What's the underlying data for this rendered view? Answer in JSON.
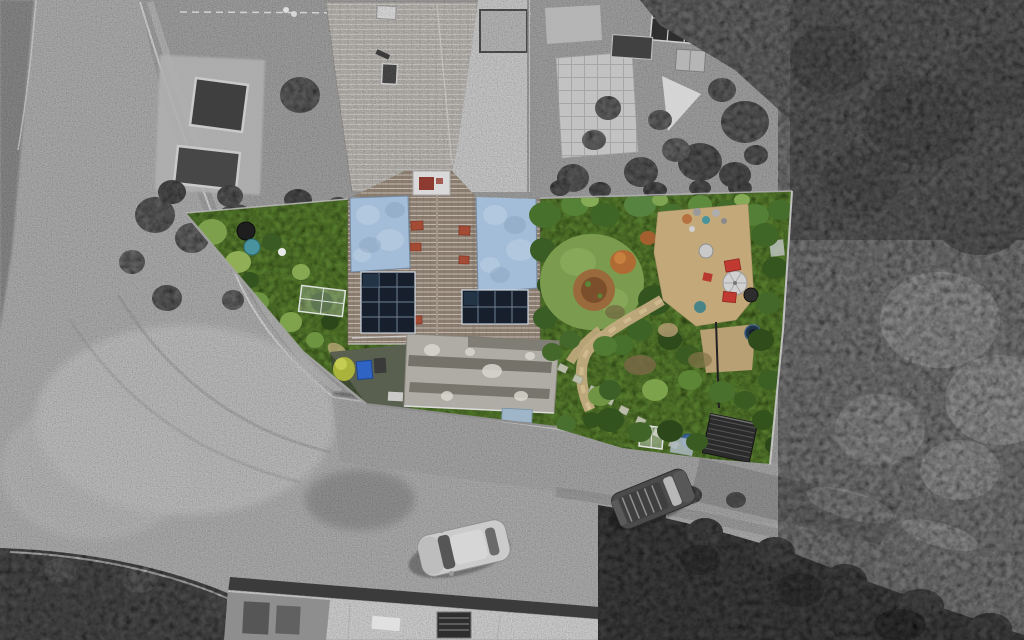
{
  "scene": {
    "type": "aerial-drone-photograph",
    "subject": "Top-down property photograph with the plot shown in colour and the surroundings desaturated to grayscale",
    "style": "estate-agent property highlight"
  },
  "property": {
    "house": {
      "tiled_roof": true,
      "chimney": true,
      "flat_roof_sections": 2,
      "solar_arrays": [
        {
          "position": "left",
          "columns": 3,
          "rows": 4
        },
        {
          "position": "right",
          "columns": 4,
          "rows": 2
        }
      ],
      "rear_extension_flat_roof": true,
      "skylight": true
    },
    "garden": {
      "left_garden": [
        "vegetable patch",
        "black water butt",
        "teal water butt",
        "cold frame",
        "yellow bush",
        "blue wheelie bin"
      ],
      "rear_garden": [
        "lawn",
        "circular brown flower bed",
        "autumn shrub",
        "gravel patio",
        "parasol",
        "red garden chairs",
        "round table",
        "blue glazed pot",
        "terracotta pots",
        "stepping stone path",
        "corrugated shed roof",
        "white cold frame",
        "blue barrel",
        "washing line pole"
      ]
    }
  },
  "surroundings": {
    "roads": [
      "left road",
      "junction",
      "bottom road"
    ],
    "vehicles": [
      {
        "id": "car-light",
        "tone": "light grey",
        "location": "bottom road"
      },
      {
        "id": "car-dark",
        "tone": "dark grey",
        "location": "bottom road"
      }
    ],
    "neighbours": [
      "front garden with raised beds",
      "patio with conservatory glazing",
      "white tarp",
      "dense tree canopy right",
      "hedge bottom-left"
    ],
    "building": "flat-roofed building at bottom centre with stair hatch"
  },
  "colors": {
    "base_gray": "#9b9b9b",
    "asphalt": "#a8a8a8",
    "junction_light": "#bdbdbd",
    "gray_veg": "#6f6f6f",
    "gray_veg_dark": "#555555",
    "gray_tree": "#5a5a5a",
    "hedge_dark": "#474747",
    "trees_bottom_right": "#3a3a3a",
    "building_roof": "#cbcbcb",
    "building_edge": "#3b3b3b",
    "front_roof": "#b2afaa",
    "driveway": "#c5c5c5",
    "neighbor_ground": "#9c9c9c",
    "patio_gray": "#c2c2c2",
    "glass_dark": "#2e2e2e",
    "garden_green": "#55792f",
    "lawn": "#7b9c4e",
    "flower_bed_brown": "#9a6a3d",
    "autumn_orange": "#b06a33",
    "tile_roof": "#8a7d70",
    "vent_terracotta": "#a34b34",
    "chimney_white": "#d9d9d9",
    "chimney_red": "#8d3b30",
    "flat_roof_blue": "#a3bcd8",
    "flat_roof_blue_light": "#c0d1e4",
    "solar_panel": "#161f2b",
    "solar_frame": "#cfd8e2",
    "solar_grid": "#6e8094",
    "extension_roof": "#aeaca4",
    "extension_band": "#6e6b63",
    "skylight_blue": "#9fb6c9",
    "patio_tan": "#c3a87a",
    "path_tan": "#c2ab7f",
    "stone_pale": "#ccc2a6",
    "stone_green": "#b9bda8",
    "chair_red": "#c13a31",
    "parasol_gray": "#d0d0d0",
    "pot_blue": "#1f3346",
    "barrel_teal": "#48939d",
    "barrel_black": "#1e1e1e",
    "barrel_blue": "#3a6399",
    "bin_blue": "#2f63c4",
    "bush_yellow": "#aab33c",
    "shed_dark": "#2b2b2b",
    "fence_light": "#c6c6c6",
    "wall_gray": "#a2a2a2",
    "car_light_body": "#cbcbcb",
    "car_dark_body": "#4b4b4b",
    "car_window": "#565656",
    "dirt_brown": "#7a6847"
  }
}
